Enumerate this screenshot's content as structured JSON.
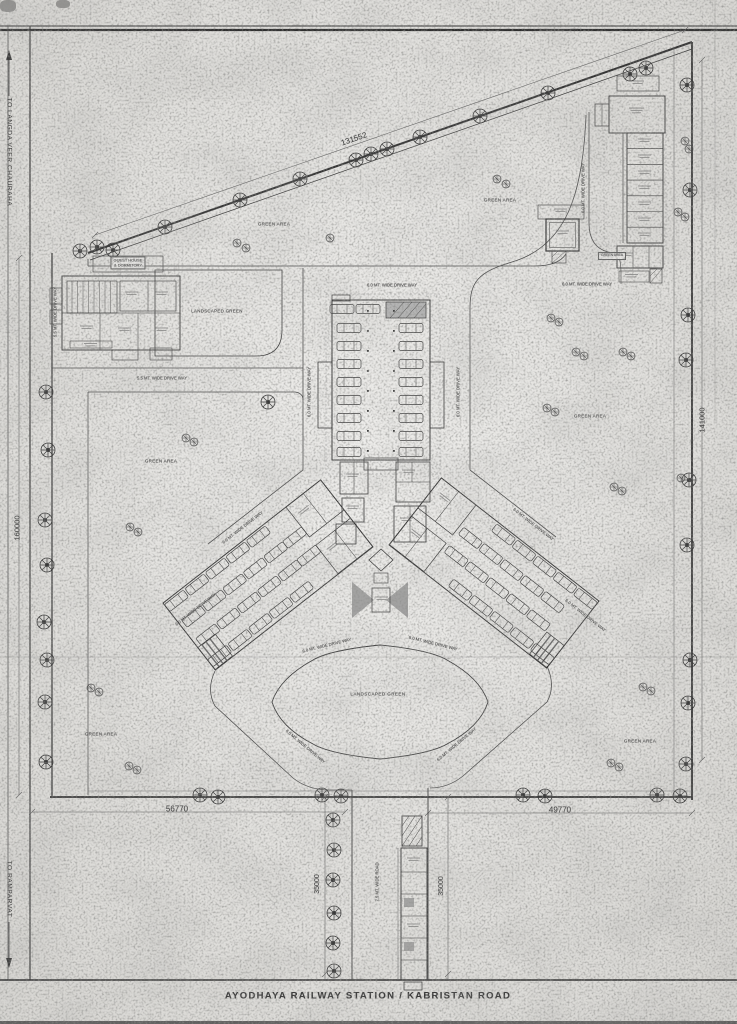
{
  "sheet": {
    "title": "AYODHAYA RAILWAY STATION / KABRISTAN ROAD"
  },
  "roads": {
    "left_top": "TO LANGDA VEER CHAURAHA",
    "left_bottom": "TO RAMPARVAT",
    "access_road": "7.5 MT. WIDE ROAD",
    "driveway_6m": "6.0 MT. WIDE DRIVE WAY",
    "driveway_5_5m": "5.5 MT. WIDE DRIVE WAY"
  },
  "dimensions": {
    "north": "131552",
    "west": "160000",
    "east": "141000",
    "south_west": "56770",
    "south_east": "49770",
    "access_road": "35000"
  },
  "areas": {
    "green_area": "GREEN AREA",
    "landscaped_green": "LANDSCAPED GREEN"
  },
  "buildings": {
    "guest_house_line1": "GUEST HOUSE",
    "guest_house_line2": "& DORMITORY"
  },
  "colors": {
    "ink": "#3c3c3c",
    "paper": "#e8e7e4"
  }
}
